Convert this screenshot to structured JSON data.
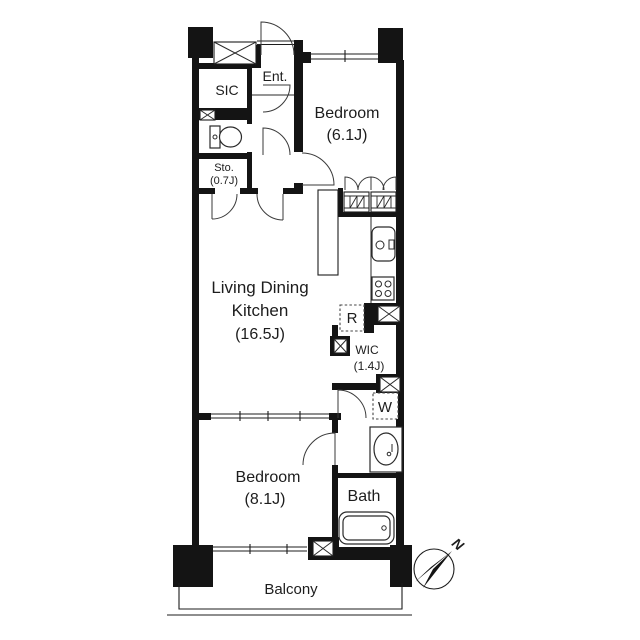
{
  "plan": {
    "rooms": {
      "sic": {
        "label": "SIC"
      },
      "entrance": {
        "label": "Ent."
      },
      "bedroom_a": {
        "label": "Bedroom",
        "size": "(6.1J)"
      },
      "storage": {
        "label": "Sto.",
        "size": "(0.7J)"
      },
      "ldk": {
        "label_line1": "Living Dining",
        "label_line2": "Kitchen",
        "size": "(16.5J)"
      },
      "refrigerator": {
        "label": "R"
      },
      "wic": {
        "label": "WIC",
        "size": "(1.4J)"
      },
      "washer": {
        "label": "W"
      },
      "bath": {
        "label": "Bath"
      },
      "bedroom_b": {
        "label": "Bedroom",
        "size": "(8.1J)"
      },
      "balcony": {
        "label": "Balcony"
      }
    },
    "compass": {
      "north_label": "N"
    },
    "fixtures": [
      "toilet-icon",
      "kitchen-sink-icon",
      "gas-stove-icon",
      "washbasin-icon",
      "bathtub-icon",
      "closet-hanger-icon",
      "pipe-shaft-icon",
      "north-arrow-icon"
    ],
    "colors": {
      "wall": "#141414",
      "line": "#2a2a2a",
      "background": "#ffffff"
    }
  }
}
